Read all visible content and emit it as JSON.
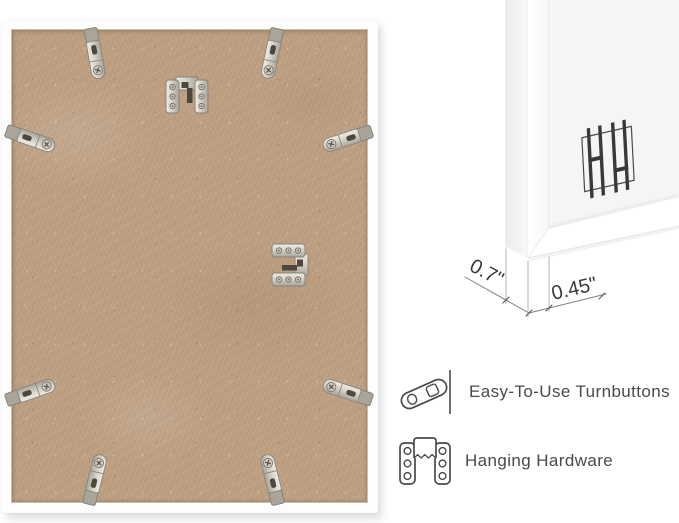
{
  "page": {
    "background_color": "#ffffff"
  },
  "photo": {
    "subject": "back of white picture frame with MDF backing board",
    "board_color": "#bc9e81",
    "frame_color": "#fdfdfd",
    "metal_color": "#d9d5cc",
    "turnbuttons": [
      {
        "x": 93,
        "y": 34,
        "angle": -10
      },
      {
        "x": 270,
        "y": 34,
        "angle": 12
      },
      {
        "x": 29,
        "y": 119,
        "angle": -71
      },
      {
        "x": 345,
        "y": 119,
        "angle": 72
      },
      {
        "x": 29,
        "y": 372,
        "angle": -109
      },
      {
        "x": 345,
        "y": 372,
        "angle": 108
      },
      {
        "x": 93,
        "y": 459,
        "angle": -166
      },
      {
        "x": 270,
        "y": 459,
        "angle": 166
      }
    ],
    "hangers": [
      {
        "x": 185,
        "y": 75,
        "angle": 0
      },
      {
        "x": 288,
        "y": 245,
        "angle": 90
      }
    ]
  },
  "corner_detail": {
    "subject": "white frame corner close-up",
    "badge_icon": "hanging-hardware-bars-icon",
    "badge_color": "#39393b"
  },
  "dimensions": {
    "depth": "0.7\"",
    "face": "0.45\""
  },
  "features": [
    {
      "icon": "turnbutton-icon",
      "label": "Easy-To-Use Turnbuttons"
    },
    {
      "icon": "hanging-hardware-icon",
      "label": "Hanging Hardware"
    }
  ]
}
